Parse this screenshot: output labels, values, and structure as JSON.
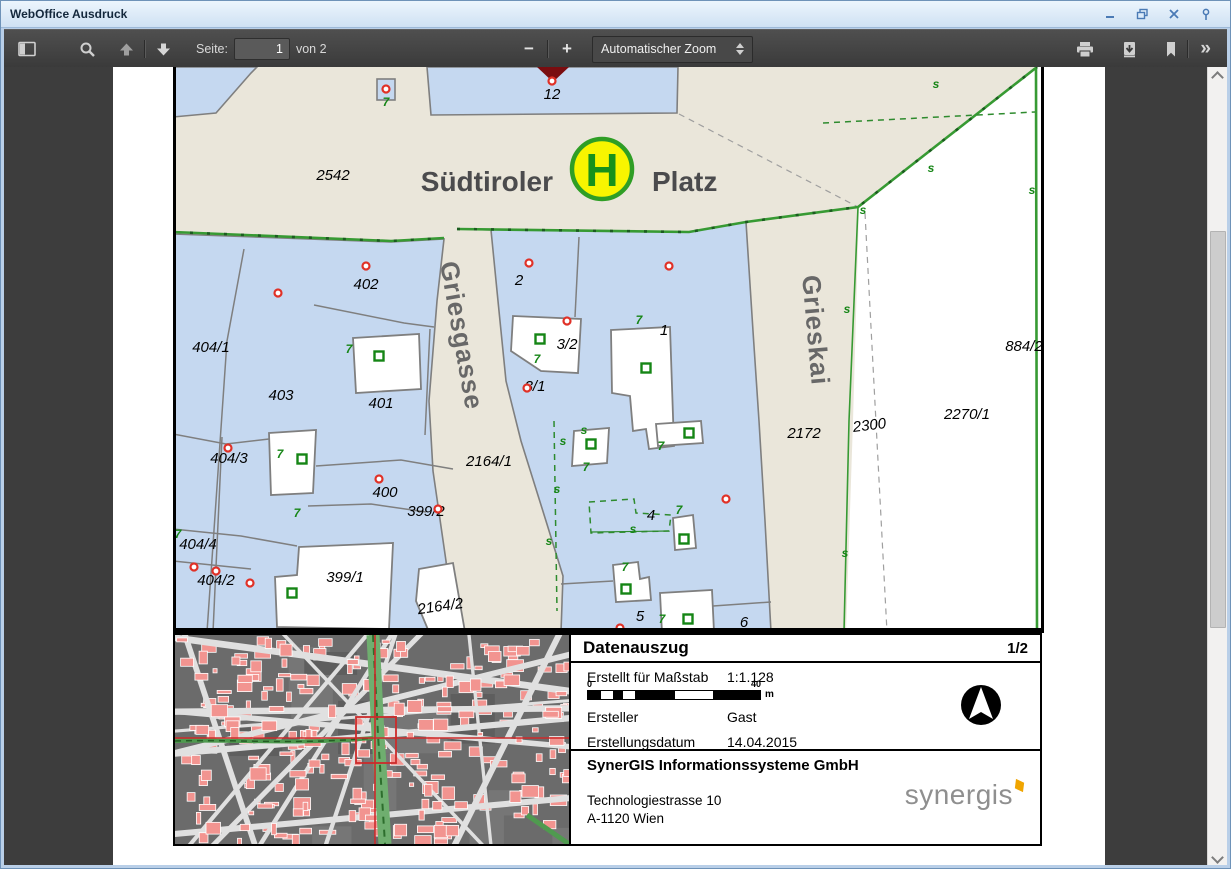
{
  "window": {
    "title": "WebOffice Ausdruck"
  },
  "toolbar": {
    "page_label": "Seite:",
    "page_value": "1",
    "page_total": "von 2",
    "zoom_out": "−",
    "zoom_in": "+",
    "zoom_select": "Automatischer Zoom",
    "more": "»"
  },
  "map": {
    "place_left": "Südtiroler",
    "place_right": "Platz",
    "stop_letter": "H",
    "street_labels": [
      {
        "text": "Griesgasse",
        "x": 452,
        "y": 336,
        "rot": 80
      },
      {
        "text": "Grieskai",
        "x": 806,
        "y": 330,
        "rot": 85
      }
    ],
    "parcel_labels": [
      {
        "text": "2542",
        "x": 332,
        "y": 179
      },
      {
        "text": "12",
        "x": 551,
        "y": 98,
        "size": 13
      },
      {
        "text": "402",
        "x": 365,
        "y": 288
      },
      {
        "text": "2",
        "x": 518,
        "y": 284
      },
      {
        "text": "404/1",
        "x": 210,
        "y": 351
      },
      {
        "text": "3/2",
        "x": 566,
        "y": 348
      },
      {
        "text": "3/1",
        "x": 534,
        "y": 390
      },
      {
        "text": "1",
        "x": 663,
        "y": 334
      },
      {
        "text": "884/2",
        "x": 1023,
        "y": 350
      },
      {
        "text": "403",
        "x": 280,
        "y": 399
      },
      {
        "text": "401",
        "x": 380,
        "y": 407
      },
      {
        "text": "2172",
        "x": 803,
        "y": 437
      },
      {
        "text": "2300",
        "x": 869,
        "y": 429,
        "rot": -7
      },
      {
        "text": "2270/1",
        "x": 966,
        "y": 418
      },
      {
        "text": "404/3",
        "x": 228,
        "y": 462
      },
      {
        "text": "2164/1",
        "x": 488,
        "y": 465
      },
      {
        "text": "400",
        "x": 384,
        "y": 496
      },
      {
        "text": "399/2",
        "x": 425,
        "y": 515
      },
      {
        "text": "404/4",
        "x": 197,
        "y": 548
      },
      {
        "text": "404/2",
        "x": 215,
        "y": 584
      },
      {
        "text": "399/1",
        "x": 344,
        "y": 581
      },
      {
        "text": "2164/2",
        "x": 440,
        "y": 610,
        "rot": -8
      },
      {
        "text": "4",
        "x": 650,
        "y": 519
      },
      {
        "text": "5",
        "x": 639,
        "y": 620
      },
      {
        "text": "6",
        "x": 743,
        "y": 626
      }
    ],
    "red_markers": [
      [
        551,
        80
      ],
      [
        385,
        88
      ],
      [
        277,
        292
      ],
      [
        365,
        265
      ],
      [
        528,
        262
      ],
      [
        668,
        265
      ],
      [
        566,
        320
      ],
      [
        526,
        387
      ],
      [
        227,
        447
      ],
      [
        378,
        478
      ],
      [
        437,
        508
      ],
      [
        725,
        498
      ],
      [
        193,
        566
      ],
      [
        215,
        570
      ],
      [
        249,
        582
      ],
      [
        619,
        627
      ]
    ],
    "green_squares": [
      [
        378,
        355
      ],
      [
        539,
        338
      ],
      [
        645,
        367
      ],
      [
        590,
        443
      ],
      [
        688,
        432
      ],
      [
        301,
        458
      ],
      [
        291,
        592
      ],
      [
        625,
        588
      ],
      [
        687,
        618
      ],
      [
        683,
        538
      ]
    ],
    "green_glyphs": [
      [
        385,
        105,
        "7"
      ],
      [
        348,
        352,
        "7"
      ],
      [
        536,
        362,
        "7"
      ],
      [
        638,
        323,
        "7"
      ],
      [
        279,
        457,
        "7"
      ],
      [
        296,
        516,
        "7"
      ],
      [
        177,
        537,
        "7"
      ],
      [
        585,
        470,
        "7"
      ],
      [
        660,
        449,
        "7"
      ],
      [
        624,
        570,
        "7"
      ],
      [
        661,
        622,
        "7"
      ],
      [
        678,
        513,
        "7"
      ],
      [
        562,
        444,
        "s"
      ],
      [
        556,
        492,
        "s"
      ],
      [
        548,
        544,
        "s"
      ],
      [
        583,
        433,
        "s"
      ],
      [
        632,
        532,
        "s"
      ],
      [
        935,
        87,
        "s"
      ],
      [
        862,
        213,
        "s"
      ],
      [
        1031,
        193,
        "s"
      ],
      [
        930,
        171,
        "s"
      ],
      [
        846,
        312,
        "s"
      ],
      [
        844,
        556,
        "s"
      ]
    ],
    "colors": {
      "parcel_blue": "#c5d8f0",
      "street_beige": "#eae6da",
      "boundary_gray": "#7f7f7f",
      "green_line": "#379a33",
      "red_marker": "#e03127",
      "green_symbol": "#158515",
      "triangle_red": "#7a0d10",
      "logo_yellow": "#f8f500",
      "logo_green": "#2f9e25"
    }
  },
  "panel": {
    "title": "Datenauszug",
    "page": "1/2",
    "rows": [
      {
        "label": "Erstellt für Maßstab",
        "value": "1:1.128"
      },
      {
        "label": "Ersteller",
        "value": "Gast"
      },
      {
        "label": "Erstellungsdatum",
        "value": "14.04.2015"
      }
    ],
    "scale": {
      "start": "0",
      "end": "40",
      "unit": "m"
    },
    "company": "SynerGIS Informationssysteme GmbH",
    "address_line1": "Technologiestrasse 10",
    "address_line2": "A-1120 Wien",
    "logo_text": "synergis"
  }
}
